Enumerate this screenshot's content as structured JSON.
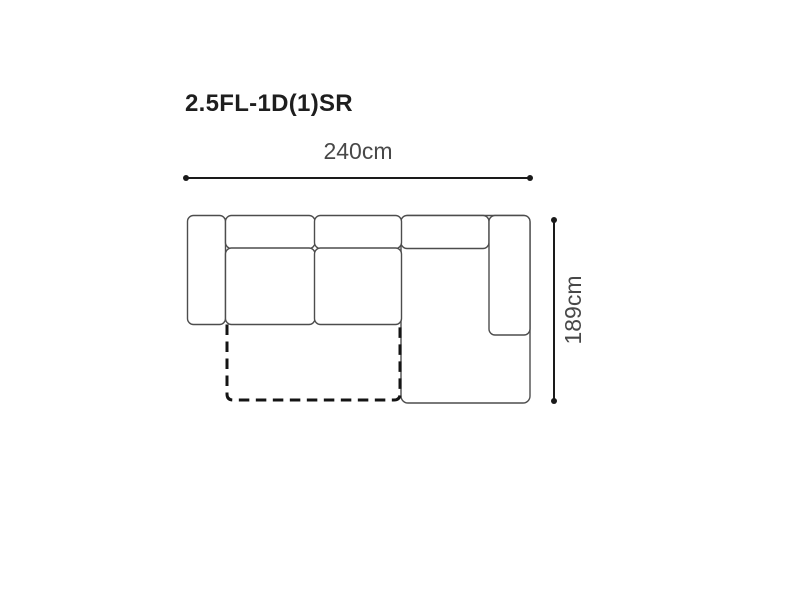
{
  "title": "2.5FL-1D(1)SR",
  "dimensions": {
    "width": {
      "label": "240cm",
      "value_cm": 240
    },
    "depth": {
      "label": "189cm",
      "value_cm": 189
    }
  },
  "figure": {
    "type": "sofa-top-view-dimension-diagram",
    "parts": [
      "left-armrest",
      "back-cushion-left",
      "back-cushion-middle",
      "seat-cushion-left",
      "seat-cushion-middle",
      "chaise-section-body",
      "back-cushion-right",
      "right-armrest",
      "pullout-footprint-dashed"
    ]
  },
  "colors": {
    "background": "#ffffff",
    "sofa_outline": "#4d4d4d",
    "dimension_line": "#1a1a1a",
    "dashed_outline": "#141414",
    "title_text": "#1e1e1e",
    "dimension_text": "#484848"
  }
}
